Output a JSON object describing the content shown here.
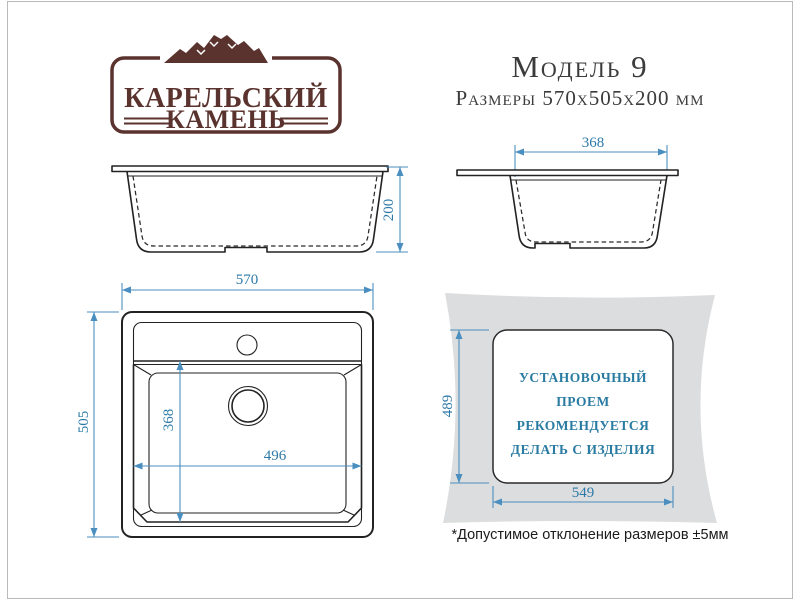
{
  "brand": {
    "name_line1": "КАРЕЛЬСКИЙ",
    "name_line2": "КАМЕНЬ"
  },
  "header": {
    "model": "Модель 9",
    "size_line": "Размеры 570x505x200 мм"
  },
  "dims": {
    "height": "200",
    "bowl_depth_side": "368",
    "overall_width": "570",
    "overall_depth": "505",
    "bowl_depth_top": "368",
    "bowl_width": "496",
    "cutout_depth": "489",
    "cutout_width": "549"
  },
  "install_note": [
    "УСТАНОВОЧНЫЙ",
    "ПРОЕМ",
    "РЕКОМЕНДУЕТСЯ",
    "ДЕЛАТЬ С ИЗДЕЛИЯ"
  ],
  "footnote": "*Допустимое отклонение размеров ±5мм",
  "colors": {
    "dimension_line": "#4a8fbf",
    "dimension_text": "#2d7aa8",
    "install_text": "#2a7ba2",
    "brand": "#5a332e",
    "countertop_fill": "#dcddde",
    "drawing_line": "#222222"
  }
}
